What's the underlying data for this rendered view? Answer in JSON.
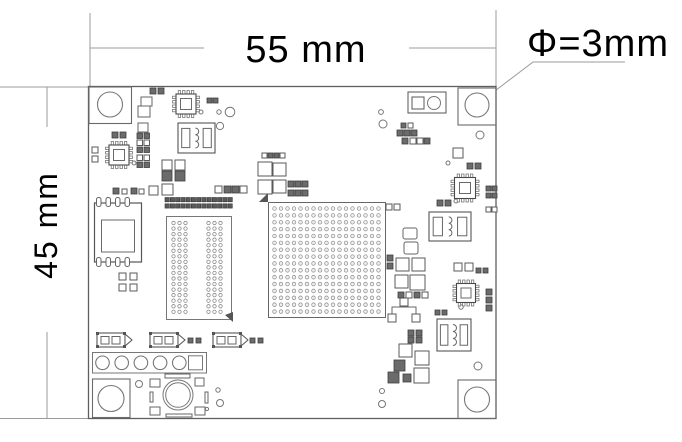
{
  "labels": {
    "board_width": "55 mm",
    "board_height": "45 mm",
    "hole_diameter": "Φ=3mm"
  },
  "colors": {
    "background": "#ffffff",
    "board_outline": "#5f5f5f",
    "component_line": "#555555",
    "light_line": "#8a8a8a",
    "pad_dark": "#6b6b6b",
    "dimension_line": "#9b9b9b",
    "text": "#000000"
  },
  "counts": {
    "mounting_holes": 4,
    "bga_grid": {
      "cols": 17,
      "rows": 16
    },
    "via_array": {
      "rows": 17,
      "dots_per_group": 3,
      "groups": 2
    },
    "pin_header": {
      "cols": 13,
      "rows": 2
    },
    "edge_connector": {
      "round_holes": 5,
      "square_pads": 1
    },
    "qfn_ics": 4,
    "inductors": 3,
    "polarized_caps": 3
  }
}
